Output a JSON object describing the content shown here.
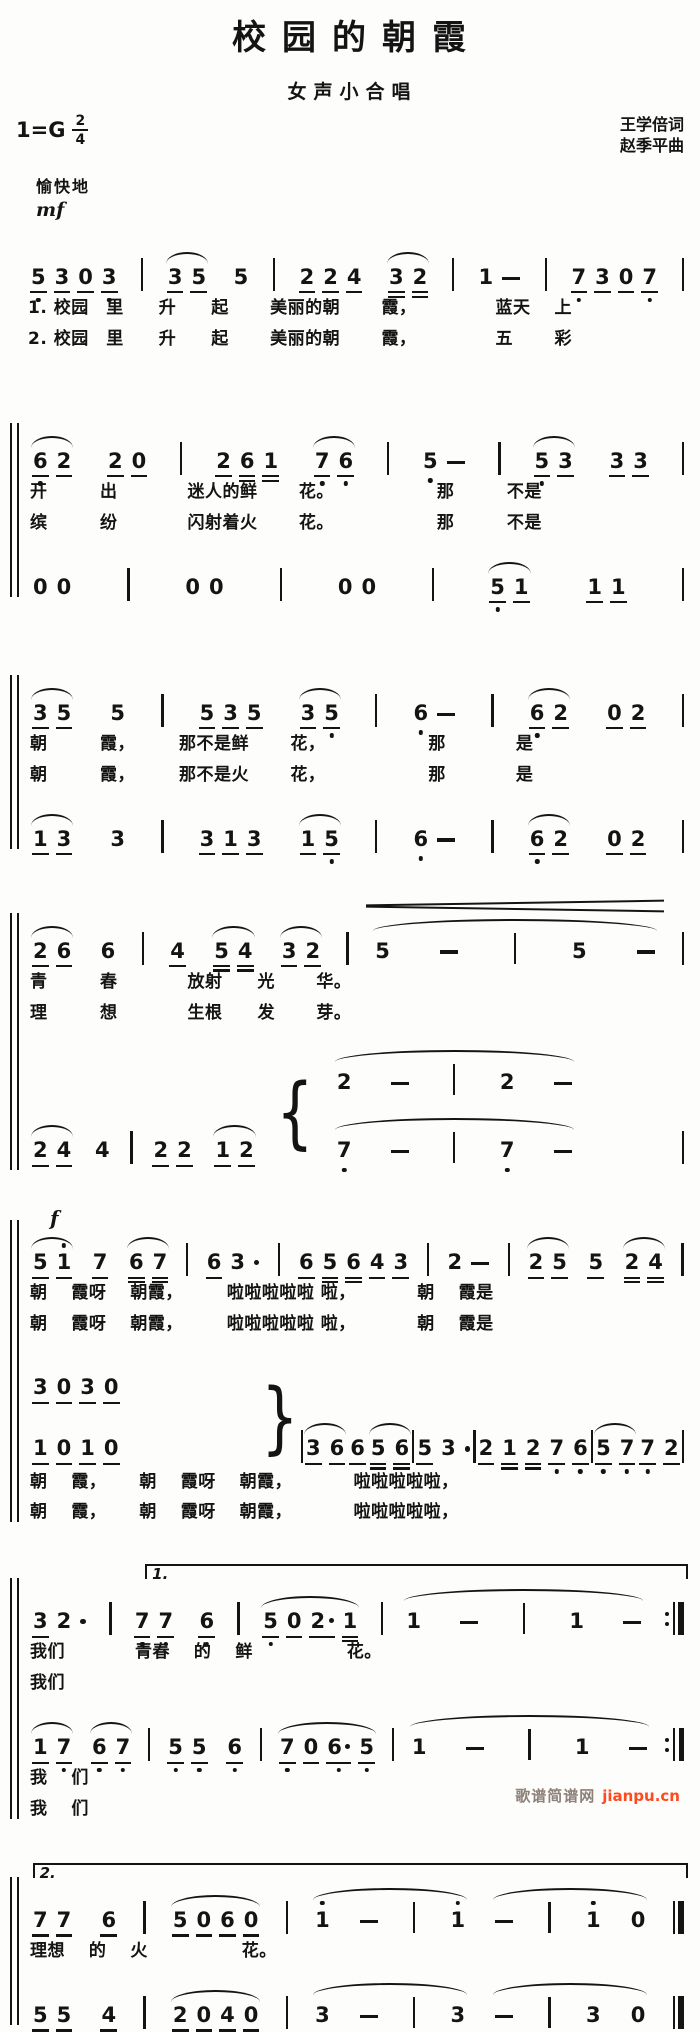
{
  "meta": {
    "title": "校园的朝霞",
    "subtitle": "女声小合唱",
    "key_prefix": "1=G",
    "time_num": "2",
    "time_den": "4",
    "credit_lyricist": "王学倍词",
    "credit_composer": "赵季平曲",
    "tempo": "愉快地",
    "dynamic_start": "mf"
  },
  "colors": {
    "ink": "#141414",
    "paper": "#fdfdfb",
    "footer_gray": "#8d8178",
    "footer_link_orange": "#ff4a1f"
  },
  "footer": {
    "site_name": "歌谱简谱网",
    "site_url": "jianpu.cn"
  },
  "systems": [
    {
      "bracket": false,
      "rows": [
        {
          "notes": [
            {
              "notes": [
                "5_,",
                "3_",
                "0_",
                "3_,"
              ]
            },
            {
              "bar": "single"
            },
            {
              "slur": true,
              "notes": [
                "3_",
                "5_"
              ]
            },
            {
              "notes": [
                "5"
              ]
            },
            {
              "bar": "single"
            },
            {
              "notes": [
                "2_",
                "2_",
                "4_"
              ]
            },
            {
              "slur": true,
              "notes": [
                "3=",
                "2="
              ]
            },
            {
              "bar": "single"
            },
            {
              "notes": [
                "1",
                "-"
              ]
            },
            {
              "bar": "single"
            },
            {
              "notes": [
                "7_,",
                "3_",
                "0_",
                "7_,"
              ]
            },
            {
              "bar": "single"
            }
          ]
        },
        {
          "lyrics": "1. 校园　里　　升　　起　　 美丽的朝　　 霞，　　　　　蓝天　 上"
        },
        {
          "lyrics": "2. 校园　里　　升　　起　　 美丽的朝　　 霞，　　　　　五　　 彩"
        }
      ]
    },
    {
      "bracket": true,
      "rows": [
        {
          "notes": [
            {
              "slur": true,
              "notes": [
                "6_,",
                "2_"
              ]
            },
            {
              "notes": [
                "2_",
                "0_"
              ]
            },
            {
              "bar": "single"
            },
            {
              "notes": [
                "2_",
                "6=",
                "1="
              ]
            },
            {
              "slur": true,
              "notes": [
                "7_,",
                "6_,"
              ]
            },
            {
              "bar": "single"
            },
            {
              "notes": [
                "5,",
                "-"
              ]
            },
            {
              "bar": "single"
            },
            {
              "slur": true,
              "notes": [
                "5_,",
                "3_"
              ]
            },
            {
              "notes": [
                "3_",
                "3_"
              ]
            },
            {
              "bar": "single"
            }
          ]
        },
        {
          "lyrics": "开　　　出　　　　迷人的鲜　　 花。　　　　　　 那　　　不是"
        },
        {
          "lyrics": "缤　　　纷　　　　闪射着火　　 花。　　　　　　 那　　　不是"
        },
        {
          "notes": [
            {
              "notes": [
                "0",
                "0"
              ]
            },
            {
              "bar": "single"
            },
            {
              "notes": [
                "0",
                "0"
              ]
            },
            {
              "bar": "single"
            },
            {
              "notes": [
                "0",
                "0"
              ]
            },
            {
              "bar": "single"
            },
            {
              "slur": true,
              "notes": [
                "5_,",
                "1_"
              ]
            },
            {
              "notes": [
                "1_",
                "1_"
              ]
            },
            {
              "bar": "single"
            }
          ]
        }
      ]
    },
    {
      "bracket": true,
      "rows": [
        {
          "notes": [
            {
              "slur": true,
              "notes": [
                "3_",
                "5_"
              ]
            },
            {
              "notes": [
                "5"
              ]
            },
            {
              "bar": "single"
            },
            {
              "notes": [
                "5_",
                "3_",
                "5_"
              ]
            },
            {
              "slur": true,
              "notes": [
                "3_",
                "5_,"
              ]
            },
            {
              "bar": "single"
            },
            {
              "notes": [
                "6,",
                "-"
              ]
            },
            {
              "bar": "single"
            },
            {
              "slur": true,
              "notes": [
                "6_,",
                "2_"
              ]
            },
            {
              "notes": [
                "0_",
                "2_"
              ]
            },
            {
              "bar": "single"
            }
          ]
        },
        {
          "lyrics": "朝　　　霞，　　　那不是鲜　　 花，　　　　　　 那　　　　是"
        },
        {
          "lyrics": "朝　　　霞，　　　那不是火　　 花，　　　　　　 那　　　　是"
        },
        {
          "notes": [
            {
              "slur": true,
              "notes": [
                "1_",
                "3_"
              ]
            },
            {
              "notes": [
                "3"
              ]
            },
            {
              "bar": "single"
            },
            {
              "notes": [
                "3_",
                "1_",
                "3_"
              ]
            },
            {
              "slur": true,
              "notes": [
                "1_",
                "5_,"
              ]
            },
            {
              "bar": "single"
            },
            {
              "notes": [
                "6,",
                "-"
              ]
            },
            {
              "bar": "single"
            },
            {
              "slur": true,
              "notes": [
                "6_,",
                "2_"
              ]
            },
            {
              "notes": [
                "0_",
                "2_"
              ]
            },
            {
              "bar": "single"
            }
          ]
        }
      ]
    },
    {
      "bracket": true,
      "rows": [
        {
          "notes": [
            {
              "slur": true,
              "notes": [
                "2_",
                "6_"
              ]
            },
            {
              "notes": [
                "6"
              ]
            },
            {
              "bar": "single"
            },
            {
              "notes": [
                "4_"
              ]
            },
            {
              "slur": true,
              "notes": [
                "5=",
                "4="
              ]
            },
            {
              "slur": true,
              "notes": [
                "3_",
                "2_"
              ]
            },
            {
              "bar": "single"
            },
            {
              "slur": true,
              "cresc": true,
              "wide": 3,
              "notes": [
                "5",
                "-",
                "|",
                "5",
                "-"
              ]
            },
            {
              "bar": "single"
            }
          ]
        },
        {
          "lyrics": "青　　　春　　　　放射　　光　　 华。"
        },
        {
          "lyrics": "理　　　想　　　　生根　　发　　 芽。"
        },
        {
          "notes": [
            {
              "slur": true,
              "notes": [
                "2_",
                "4_"
              ]
            },
            {
              "notes": [
                "4"
              ]
            },
            {
              "bar": "single"
            },
            {
              "notes": [
                "2_",
                "2_"
              ]
            },
            {
              "slur": true,
              "notes": [
                "1_",
                "2_"
              ]
            },
            {
              "brace": "{"
            },
            {
              "stack": [
                [
                  {
                    "slur": true,
                    "wide": 2,
                    "notes": [
                      "2",
                      "-",
                      "|",
                      "2",
                      "-"
                    ]
                  }
                ],
                [
                  {
                    "slur": true,
                    "wide": 2,
                    "notes": [
                      "7,",
                      "-",
                      "|",
                      "7,",
                      "-"
                    ]
                  }
                ]
              ]
            },
            {
              "bar": "single"
            }
          ]
        }
      ]
    },
    {
      "bracket": true,
      "rows": [
        {
          "dyn": "f"
        },
        {
          "notes": [
            {
              "slur": true,
              "notes": [
                "5_",
                "1'_"
              ]
            },
            {
              "notes": [
                "7_"
              ]
            },
            {
              "slur": true,
              "notes": [
                "6=",
                "7="
              ]
            },
            {
              "bar": "single"
            },
            {
              "notes": [
                "6_",
                "3",
                "."
              ]
            },
            {
              "bar": "single"
            },
            {
              "notes": [
                "6_",
                "5=",
                "6=",
                "4_",
                "3_"
              ]
            },
            {
              "bar": "single"
            },
            {
              "notes": [
                "2",
                "-"
              ]
            },
            {
              "bar": "single"
            },
            {
              "slur": true,
              "notes": [
                "2_",
                "5_"
              ]
            },
            {
              "notes": [
                "5_"
              ]
            },
            {
              "slur": true,
              "notes": [
                "2=",
                "4="
              ]
            },
            {
              "bar": "single"
            }
          ]
        },
        {
          "lyrics": "朝　 霞呀　 朝霞，　　　啦啦啦啦啦 啦，　　　　朝　 霞是"
        },
        {
          "lyrics": "朝　 霞呀　 朝霞，　　　啦啦啦啦啦 啦，　　　　朝　 霞是"
        },
        {
          "notes": [
            {
              "stack": [
                [
                  {
                    "notes": [
                      "3_",
                      "0_",
                      "3_",
                      "0_"
                    ]
                  }
                ],
                [
                  {
                    "notes": [
                      "1_",
                      "0_",
                      "1_",
                      "0_"
                    ]
                  }
                ]
              ]
            },
            {
              "brace": "}"
            },
            {
              "bar": "single"
            },
            {
              "slur": true,
              "notes": [
                "3_",
                "6_"
              ]
            },
            {
              "notes": [
                "6_"
              ]
            },
            {
              "slur": true,
              "notes": [
                "5=",
                "6="
              ]
            },
            {
              "bar": "single"
            },
            {
              "notes": [
                "5_",
                "3",
                "."
              ]
            },
            {
              "bar": "single"
            },
            {
              "notes": [
                "2_",
                "1=",
                "2=",
                "7_,",
                "6_,"
              ]
            },
            {
              "bar": "single"
            },
            {
              "slur": true,
              "notes": [
                "5_,",
                "7_,"
              ]
            },
            {
              "notes": [
                "7_,",
                "2_"
              ]
            },
            {
              "bar": "single"
            }
          ]
        },
        {
          "lyrics": "朝　 霞，　　 朝　 霞呀　 朝霞，　　　　啦啦啦啦啦，"
        },
        {
          "lyrics": "朝　 霞，　　 朝　 霞呀　 朝霞，　　　　啦啦啦啦啦，"
        }
      ]
    },
    {
      "bracket": true,
      "rows": [
        {
          "volta": "1.",
          "left": "18%"
        },
        {
          "notes": [
            {
              "notes": [
                "3_",
                "2",
                "."
              ]
            },
            {
              "bar": "single"
            },
            {
              "notes": [
                "7_,",
                "7_,"
              ]
            },
            {
              "notes": [
                "6_,"
              ]
            },
            {
              "bar": "single"
            },
            {
              "slur": true,
              "notes": [
                "5_,",
                "0_",
                "2_*",
                "1="
              ]
            },
            {
              "bar": "single"
            },
            {
              "slur": true,
              "wide": 2,
              "notes": [
                "1",
                "-",
                "|",
                "1",
                "-"
              ]
            },
            {
              "bar": "repeat"
            }
          ]
        },
        {
          "lyrics": "我们　　　　青春　 的　 鲜　　　　　 花。"
        },
        {
          "lyrics": "我们"
        },
        {
          "notes": [
            {
              "slur": true,
              "notes": [
                "1_",
                "7_,"
              ]
            },
            {
              "slur": true,
              "notes": [
                "6_,",
                "7_,"
              ]
            },
            {
              "bar": "single"
            },
            {
              "notes": [
                "5_,",
                "5_,"
              ]
            },
            {
              "notes": [
                "6_,"
              ]
            },
            {
              "bar": "single"
            },
            {
              "slur": true,
              "notes": [
                "7_,",
                "0_",
                "6_,*",
                "5_,"
              ]
            },
            {
              "bar": "single"
            },
            {
              "slur": true,
              "wide": 2,
              "notes": [
                "1",
                "-",
                "|",
                "1",
                "-"
              ]
            },
            {
              "bar": "repeat"
            }
          ]
        },
        {
          "lyrics": "我　 们"
        },
        {
          "lyrics": "我　 们"
        }
      ]
    },
    {
      "bracket": true,
      "rows": [
        {
          "volta": "2.",
          "left": "1%"
        },
        {
          "notes": [
            {
              "notes": [
                "7_",
                "7_"
              ]
            },
            {
              "notes": [
                "6_"
              ]
            },
            {
              "bar": "single"
            },
            {
              "slur": true,
              "notes": [
                "5_",
                "0_",
                "6_",
                "0_"
              ]
            },
            {
              "bar": "single"
            },
            {
              "slur": true,
              "wide": 1,
              "notes": [
                "1'",
                "-",
                "|",
                "1'"
              ]
            },
            {
              "slur": true,
              "wide": 1,
              "notes": [
                "-",
                "|",
                "1'",
                "0"
              ]
            },
            {
              "bar": "final"
            }
          ]
        },
        {
          "lyrics": "理想　 的　 火　　　　　 花。"
        },
        {
          "notes": [
            {
              "notes": [
                "5_",
                "5_"
              ]
            },
            {
              "notes": [
                "4_"
              ]
            },
            {
              "bar": "single"
            },
            {
              "slur": true,
              "notes": [
                "2_",
                "0_",
                "4_",
                "0_"
              ]
            },
            {
              "bar": "single"
            },
            {
              "slur": true,
              "wide": 1,
              "notes": [
                "3",
                "-",
                "|",
                "3"
              ]
            },
            {
              "slur": true,
              "wide": 1,
              "notes": [
                "-",
                "|",
                "3",
                "0"
              ]
            },
            {
              "bar": "final"
            }
          ]
        }
      ]
    }
  ]
}
